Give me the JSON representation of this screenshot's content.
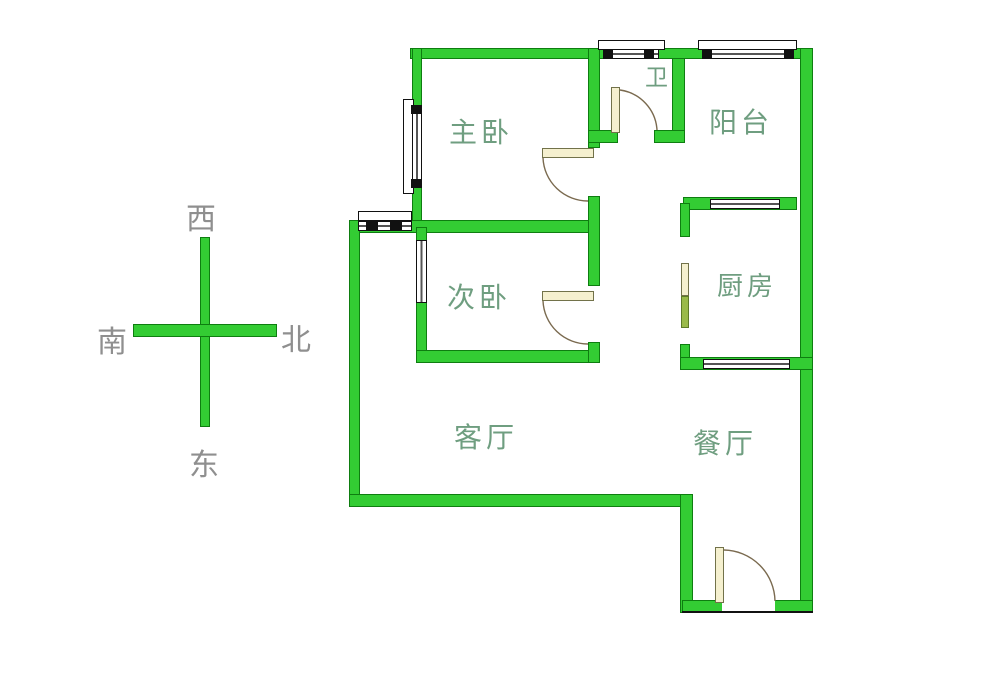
{
  "diagram_type": "apartment-floor-plan",
  "rooms": {
    "master_bedroom": {
      "label": "主卧"
    },
    "bathroom": {
      "label": "卫"
    },
    "balcony": {
      "label": "阳台"
    },
    "second_bedroom": {
      "label": "次卧"
    },
    "kitchen": {
      "label": "厨房"
    },
    "living_room": {
      "label": "客厅"
    },
    "dining_room": {
      "label": "餐厅"
    }
  },
  "compass": {
    "top": "西",
    "left": "南",
    "right": "北",
    "bottom": "东"
  },
  "palette": {
    "wall_green": "#33cc33",
    "wall_outline": "#0e7d10",
    "door_leaf": "#f5f0cf",
    "room_label_color": "#6f9e80",
    "compass_label_color": "#8f8f8f",
    "background": "#ffffff"
  }
}
